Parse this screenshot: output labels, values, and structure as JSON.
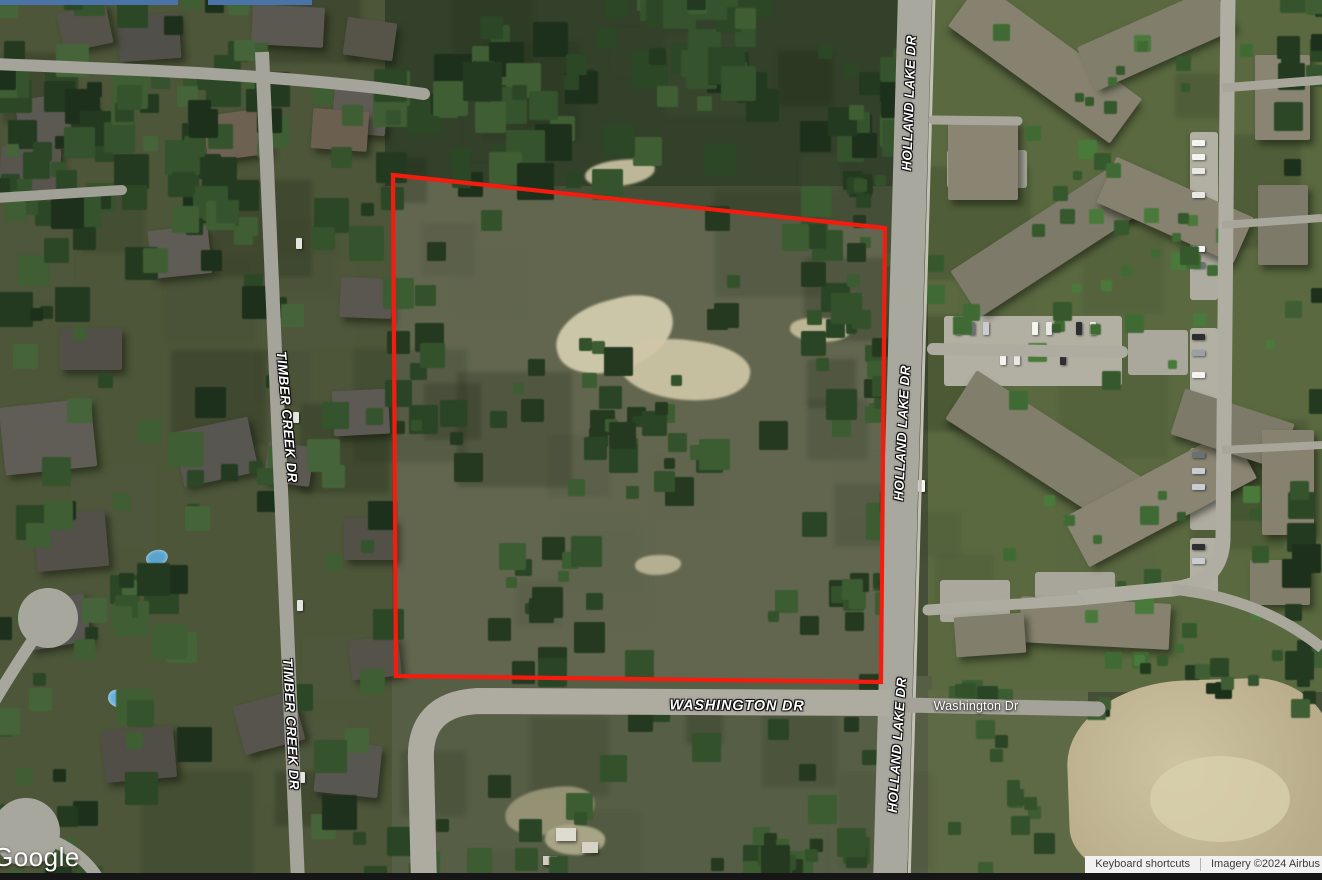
{
  "map": {
    "labels": {
      "holland_lake_dr": "HOLLAND LAKE DR",
      "timber_creek_dr": "TIMBER CREEK DR",
      "washington_dr": "WASHINGTON DR",
      "washington_dr_small": "Washington Dr"
    },
    "boundary": {
      "points": "393,175 885,228 881,682 396,676",
      "color": "#f41c0f"
    }
  },
  "branding": {
    "logo": "Google"
  },
  "footer": {
    "keyboard_shortcuts": "Keyboard shortcuts",
    "imagery_credit": "Imagery ©2024 Airbus"
  }
}
